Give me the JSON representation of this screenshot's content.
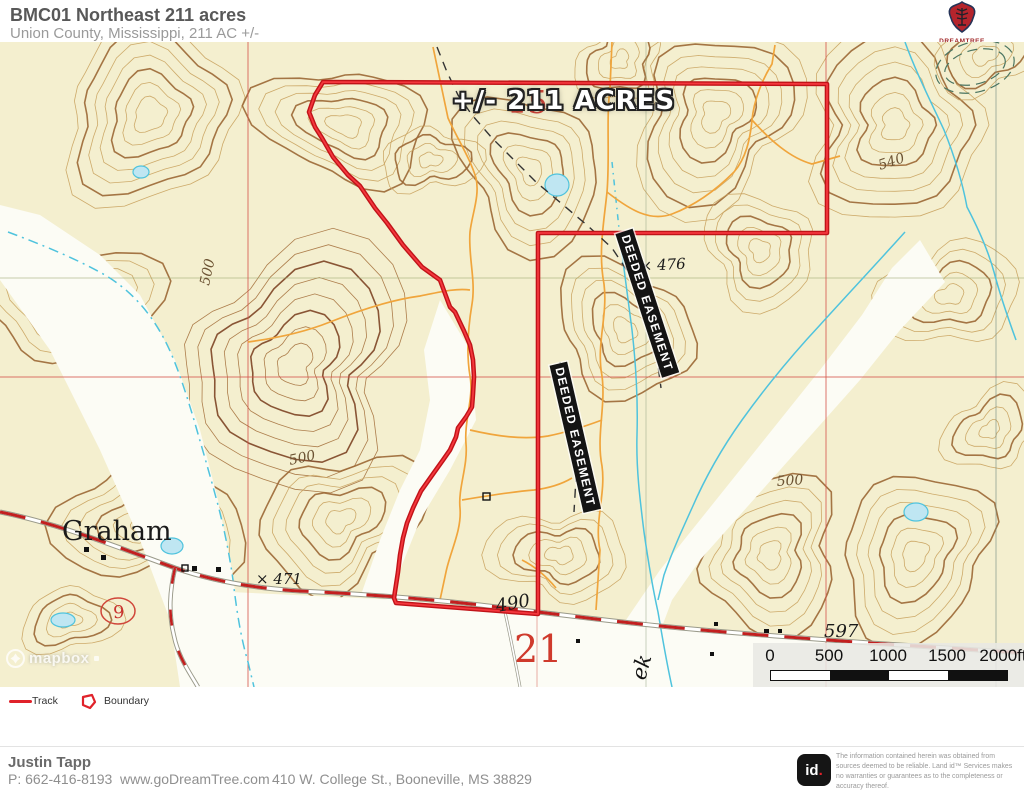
{
  "header": {
    "title": "BMC01 Northeast 211 acres",
    "subtitle": "Union County, Mississippi, 211 AC +/-"
  },
  "logo": {
    "brand": "DREAMTREE"
  },
  "map": {
    "acres_label": "+/- 211 ACRES",
    "easement_label": "DEEDED EASEMENT",
    "labels": {
      "graham": "Graham",
      "section_15": "15",
      "section_21": "21",
      "route_9": "9",
      "creek": "ek",
      "spot_476": "× 476",
      "spot_471": "× 471",
      "spot_490": "490",
      "spot_597": "597",
      "contour_540": "540",
      "contour_500_a": "500",
      "contour_500_b": "500",
      "contour_500_c": "500"
    },
    "scale_bar": {
      "ticks": [
        "0",
        "500",
        "1000",
        "1500",
        "2000ft"
      ]
    },
    "attribution": "mapbox"
  },
  "legend": {
    "track_label": "Track",
    "boundary_label": "Boundary"
  },
  "footer": {
    "agent_name": "Justin Tapp",
    "phone": "P: 662-416-8193",
    "website": "www.goDreamTree.com",
    "address": "410 W. College St., Booneville, MS 38829",
    "id_label": "id",
    "id_dot": ".",
    "disclaimer_line_1": "The information contained herein was obtained from sources deemed to be reliable.",
    "disclaimer_line_2": "Land id™ Services makes no warranties or guarantees as to the completeness or accuracy thereof."
  },
  "colors": {
    "boundary_red": "#e0222a",
    "track_red": "#c21f1f",
    "trail_orange": "#f0a53c",
    "water_blue": "#4fc3dd",
    "contour_brown": "#9b6734",
    "map_cream": "#f4efcf"
  }
}
